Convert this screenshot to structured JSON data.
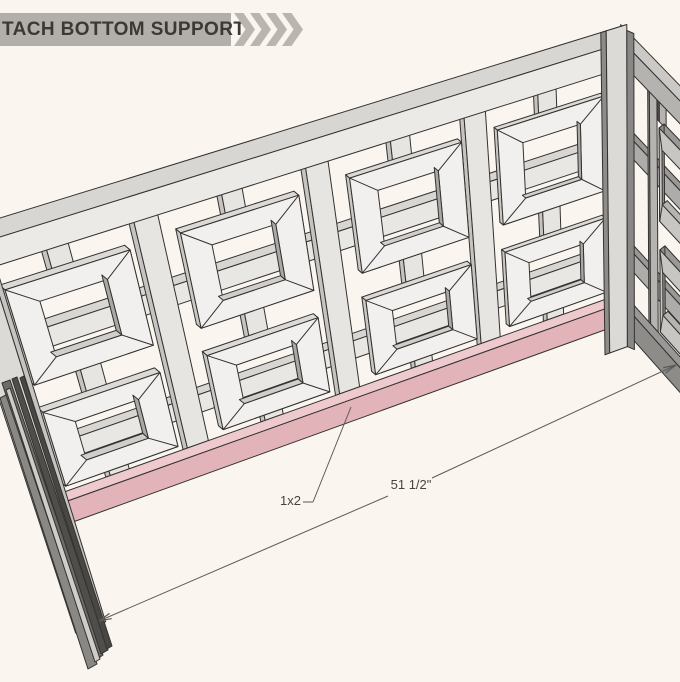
{
  "header": {
    "title": "TACH BOTTOM SUPPORT",
    "chevron_count": 4,
    "bg": "#b2aeaa",
    "text_color": "#3b3935",
    "chevron_color": "#bab6af"
  },
  "annotations": {
    "part_label": "1x2",
    "dimension_label": "51 1/2\""
  },
  "drawing": {
    "subject": "decorative lattice panel corner with pink highlighted bottom support rail",
    "background": "#faf6ef",
    "outline": "#343230",
    "wood_front": "#eceae7",
    "rail_front": "#e9e7e4",
    "stile_front": "#e7e5e2",
    "top_face": "#d8d6d3",
    "side_face": "#c6c4c1",
    "post_front": "#dcdad7",
    "frame_ring": "#f2f0ee",
    "frame_top": "#dcdad7",
    "frame_left": "#cac8c5",
    "frame_bottom": "#c9c7c4",
    "frame_right": "#bdbbb8",
    "frame_inner_right": "#aaa8a5",
    "frame_inner_bottom": "#d0cecb",
    "pink_top": "#eec9cd",
    "pink_front": "#e2b3b9",
    "side_rail_front": "#aeacaa",
    "side_top_face": "#9a9896",
    "side_stile_front": "#b6b4b1",
    "side_dark": "#8e8c89",
    "side_ring": "#c8c6c3",
    "side_rail_top": "#cbc9c6",
    "side_wood_front": "#b5b3b0",
    "dim_color": "#5c5b58",
    "bundle_colors": [
      "#6e6c68",
      "#504e4a",
      "#8a8884",
      "#494744",
      "#cfcdca"
    ]
  }
}
